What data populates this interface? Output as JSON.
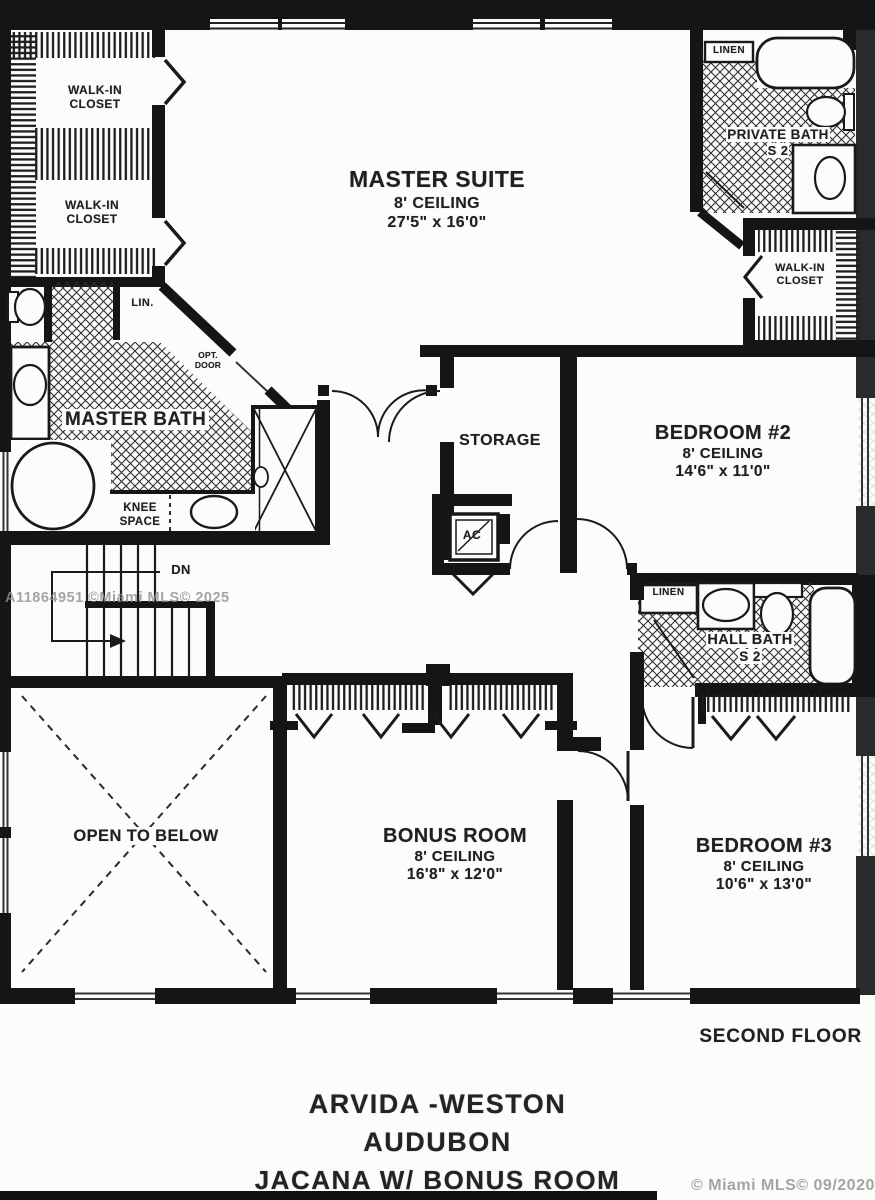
{
  "rooms": {
    "master_suite": {
      "name": "MASTER SUITE",
      "ceiling": "8' CEILING",
      "dims": "27'5\" x 16'0\""
    },
    "bedroom_2": {
      "name": "BEDROOM #2",
      "ceiling": "8' CEILING",
      "dims": "14'6\" x 11'0\""
    },
    "bedroom_3": {
      "name": "BEDROOM #3",
      "ceiling": "8' CEILING",
      "dims": "10'6\" x 13'0\""
    },
    "bonus_room": {
      "name": "BONUS ROOM",
      "ceiling": "8' CEILING",
      "dims": "16'8\" x 12'0\""
    },
    "storage": {
      "name": "STORAGE"
    },
    "open_to_below": {
      "name": "OPEN TO BELOW"
    },
    "master_bath": {
      "name": "MASTER BATH"
    },
    "private_bath": {
      "name": "PRIVATE BATH",
      "code": "S 2"
    },
    "hall_bath": {
      "name": "HALL BATH",
      "code": "S 2"
    },
    "walk_in_closet": {
      "line1": "WALK-IN",
      "line2": "CLOSET"
    },
    "knee_space": {
      "line1": "KNEE",
      "line2": "SPACE"
    }
  },
  "small_labels": {
    "lin": "LIN.",
    "linen": "LINEN",
    "ac": "AC",
    "dn": "DN",
    "opt_door_line1": "OPT.",
    "opt_door_line2": "DOOR"
  },
  "footer": {
    "floor_label": "SECOND FLOOR",
    "builder": "ARVIDA -WESTON",
    "community": "AUDUBON",
    "model": "JACANA W/ BONUS ROOM"
  },
  "watermarks": {
    "mls_center": "A11864951 ©Miami MLS© 2025",
    "mls_bottom_right": "© Miami MLS© 09/2020"
  },
  "colors": {
    "ink": "#1a1a1a",
    "paper": "#fcfcfb",
    "watermark": "#8f8f8f"
  }
}
